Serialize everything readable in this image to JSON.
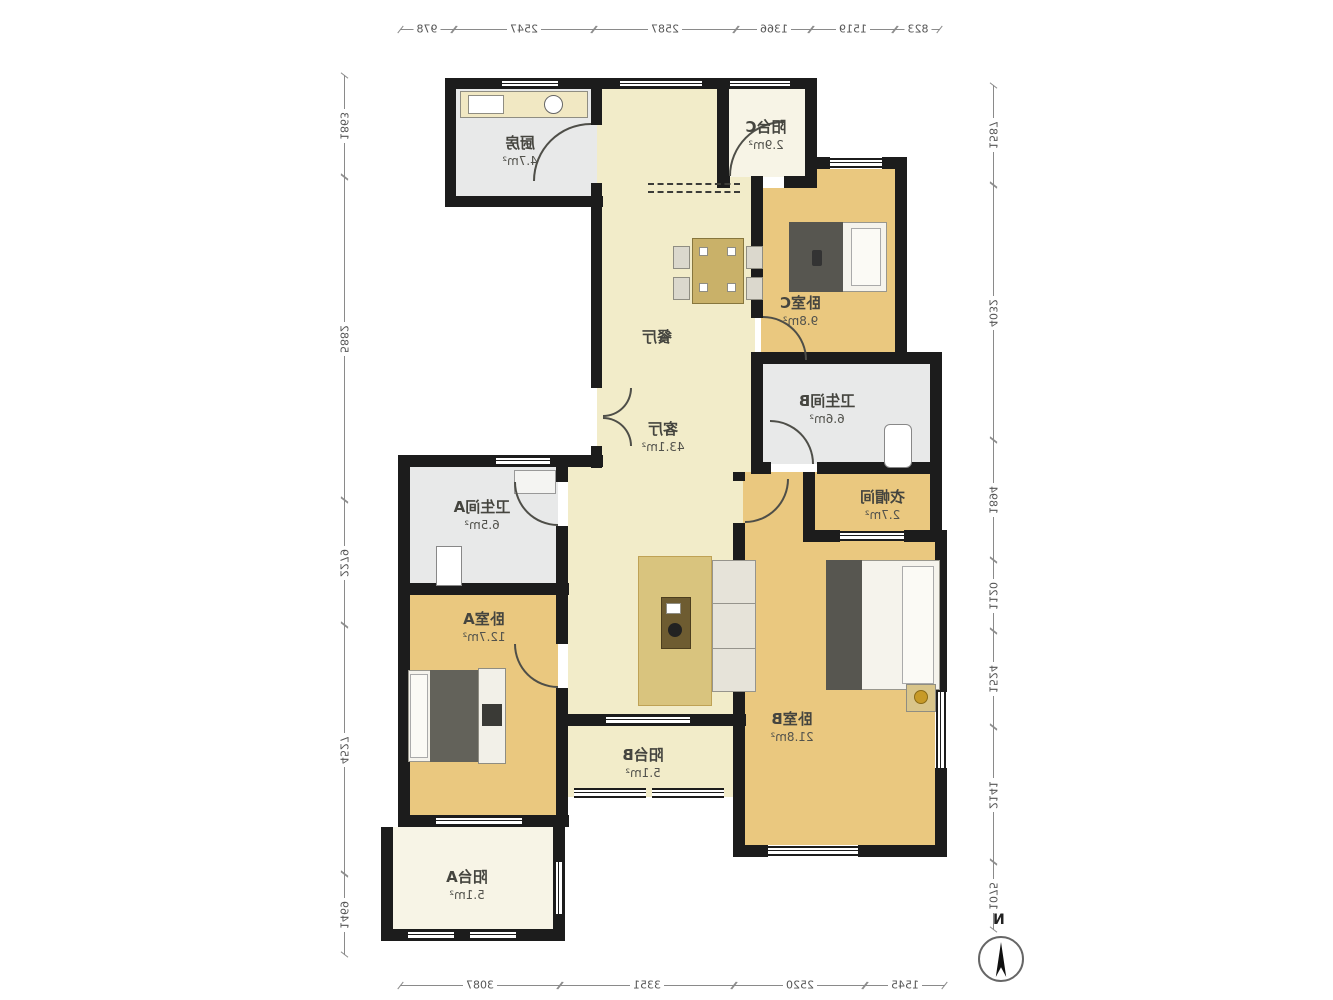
{
  "plan": {
    "compass_label": "N",
    "rooms": [
      {
        "id": "kitchen",
        "name": "厨房",
        "area": "4.7m²"
      },
      {
        "id": "balcony-c",
        "name": "阳台C",
        "area": "2.9m²"
      },
      {
        "id": "bedroom-c",
        "name": "卧室C",
        "area": "9.8m²"
      },
      {
        "id": "dining",
        "name": "餐厅",
        "area": ""
      },
      {
        "id": "bathroom-b",
        "name": "卫生间B",
        "area": "6.6m²"
      },
      {
        "id": "cloakroom",
        "name": "衣帽间",
        "area": "2.7m²"
      },
      {
        "id": "living",
        "name": "客厅",
        "area": "43.1m²"
      },
      {
        "id": "bathroom-a",
        "name": "卫生间A",
        "area": "6.5m²"
      },
      {
        "id": "bedroom-a",
        "name": "卧室A",
        "area": "12.7m²"
      },
      {
        "id": "bedroom-b",
        "name": "卧室B",
        "area": "21.8m²"
      },
      {
        "id": "balcony-b",
        "name": "阳台B",
        "area": "5.1m²"
      },
      {
        "id": "balcony-a",
        "name": "阳台A",
        "area": "5.1m²"
      }
    ],
    "dimensions_mm": {
      "top": [
        "978",
        "2547",
        "2587",
        "1366",
        "1519",
        "823"
      ],
      "bottom": [
        "3087",
        "3351",
        "2520",
        "1545"
      ],
      "left": [
        "1863",
        "5882",
        "2279",
        "4527",
        "1469"
      ],
      "right": [
        "1587",
        "4032",
        "1894",
        "1120",
        "1524",
        "2141",
        "1075"
      ]
    },
    "colors": {
      "wall": "#1c1c1c",
      "floor_cream": "#f2ecc9",
      "floor_tan": "#eac87f",
      "floor_gray": "#e8e9e9",
      "floor_pale": "#f7f4e6"
    }
  }
}
